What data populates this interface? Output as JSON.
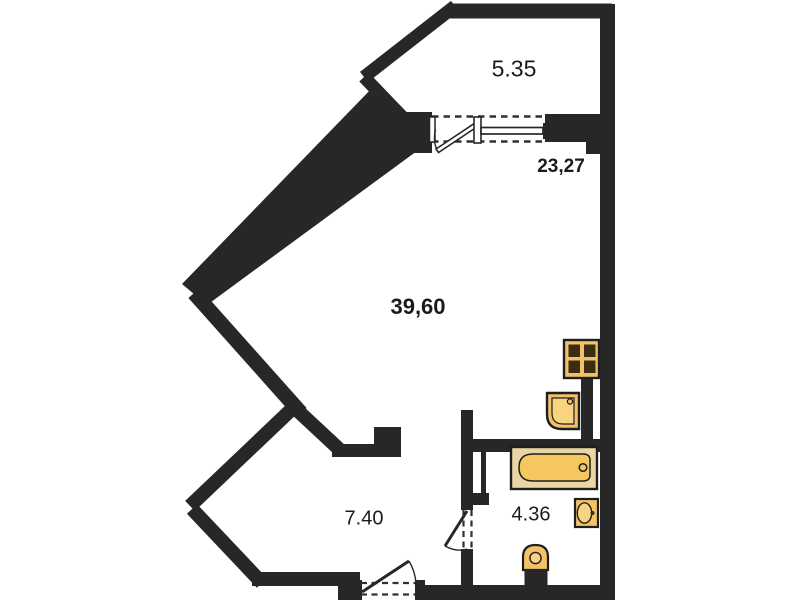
{
  "plan": {
    "title": "apartment-floor-plan",
    "rooms": [
      {
        "id": "balcony",
        "area": "5.35"
      },
      {
        "id": "living-window-zone",
        "area": "23,27"
      },
      {
        "id": "living-room",
        "area": "39,60"
      },
      {
        "id": "hallway",
        "area": "7.40"
      },
      {
        "id": "bathroom",
        "area": "4.36"
      }
    ],
    "fixtures": [
      "stove-icon",
      "kitchen-sink-icon",
      "bathtub-icon",
      "washbasin-icon",
      "toilet-icon"
    ],
    "openings": [
      "balcony-door",
      "balcony-window",
      "bathroom-door",
      "entrance-door"
    ],
    "colors": {
      "wall": "#272727",
      "dash": "#303030",
      "fixture": "#F3C167",
      "fixture_rim": "#EAD6A4",
      "fixture_inner": "#F8D480",
      "burner": "#3A2D13",
      "background": "#ffffff"
    }
  }
}
